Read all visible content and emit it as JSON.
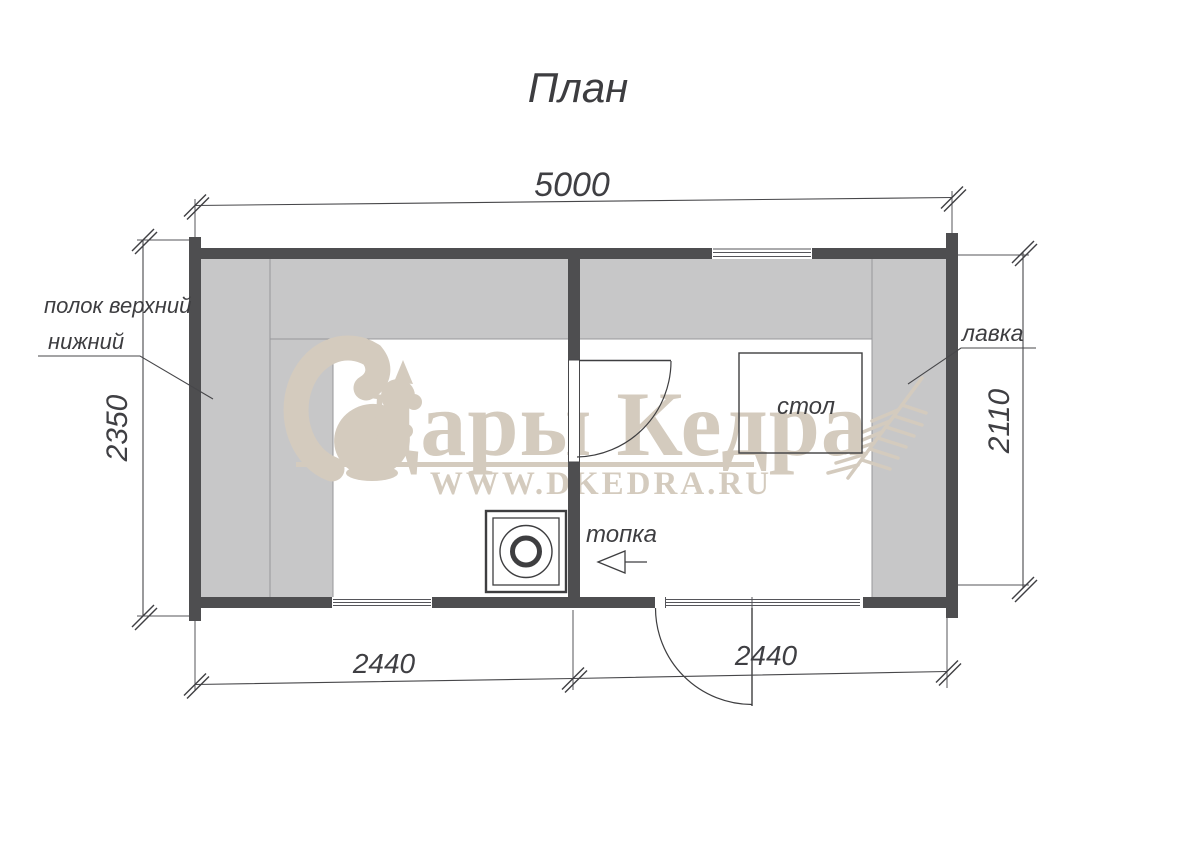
{
  "title": "План",
  "dimensions": {
    "width_total": "5000",
    "height_left_exterior": "2350",
    "height_right_interior": "2110",
    "bottom_left_room": "2440",
    "bottom_right_room": "2440"
  },
  "labels": {
    "shelf_line1": "полок верхний",
    "shelf_line2": "нижний",
    "bench": "лавка",
    "table": "стол",
    "firebox": "топка"
  },
  "watermark": {
    "brand": "Дары Кедра",
    "url": "WWW.DKEDRA.RU"
  },
  "icons": {
    "squirrel": "squirrel-logo-icon",
    "stove": "stove-top-symbol",
    "fir_branch": "fir-branch-icon",
    "firebox_arrow": "arrow-left-icon",
    "dimension_tick": "dimension-tick-mark"
  },
  "colors": {
    "wall": "#4e4e50",
    "bench_fill": "#c7c7c8",
    "watermark": "#d4cbbe",
    "line": "#47474a"
  }
}
